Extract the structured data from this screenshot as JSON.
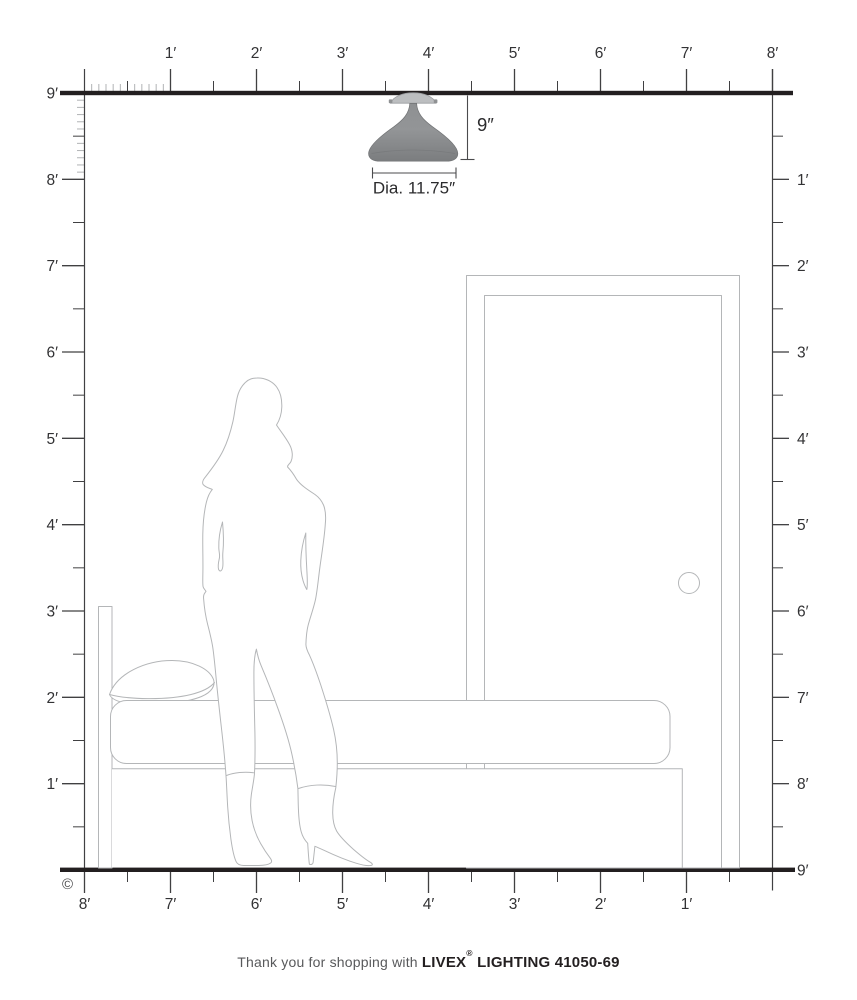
{
  "diagram": {
    "copyright_symbol": "©",
    "footer": {
      "prefix": "Thank you for shopping with",
      "brand": "LIVEX",
      "registered": "®",
      "suffix": " LIGHTING 41050-69"
    },
    "fixture": {
      "height_label": "9″",
      "diameter_label": "Dia. 11.75″"
    },
    "rulers": {
      "top_labels": [
        "1′",
        "2′",
        "3′",
        "4′",
        "5′",
        "6′",
        "7′",
        "8′"
      ],
      "bottom_labels": [
        "8′",
        "7′",
        "6′",
        "5′",
        "4′",
        "3′",
        "2′",
        "1′"
      ],
      "left_labels": [
        "9′",
        "8′",
        "7′",
        "6′",
        "5′",
        "4′",
        "3′",
        "2′",
        "1′"
      ],
      "right_labels": [
        "1′",
        "2′",
        "3′",
        "4′",
        "5′",
        "6′",
        "7′",
        "8′",
        "9′"
      ]
    }
  },
  "colors": {
    "structure_line": "#231f20",
    "tick_major": "#404042",
    "tick_minor": "#b1b3b5",
    "ruler_text": "#323234",
    "outline": "#b4b6b8",
    "dimension_line": "#4b4b4d",
    "dimension_text": "#2b2b2d",
    "shade_top": "#8e9092",
    "shade_mid": "#939597",
    "shade_bottom": "#7b7d7f",
    "canopy": "#bcbec0",
    "footer_text": "#58595b",
    "footer_brand": "#231f20"
  }
}
